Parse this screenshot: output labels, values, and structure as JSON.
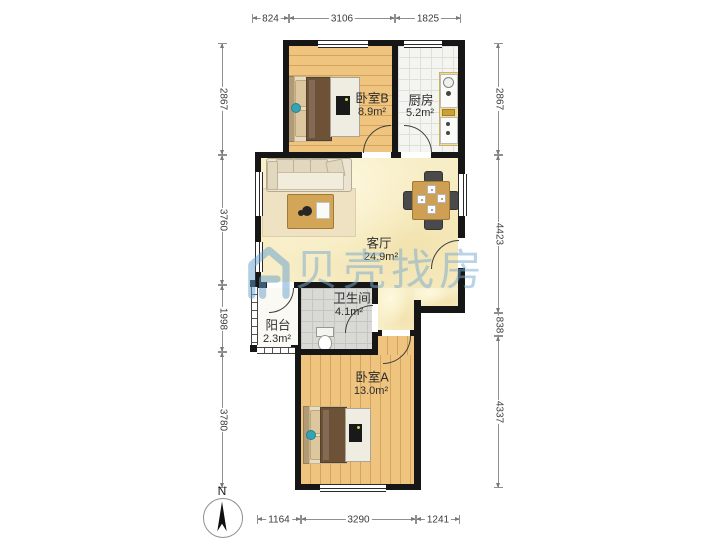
{
  "watermark": {
    "brand": "贝壳找房"
  },
  "compass": {
    "north_label": "N"
  },
  "rooms": {
    "bedroomB": {
      "name": "卧室B",
      "area": "8.9m²"
    },
    "kitchen": {
      "name": "厨房",
      "area": "5.2m²"
    },
    "living": {
      "name": "客厅",
      "area": "24.9m²"
    },
    "bathroom": {
      "name": "卫生间",
      "area": "4.1m²"
    },
    "balcony": {
      "name": "阳台",
      "area": "2.3m²"
    },
    "bedroomA": {
      "name": "卧室A",
      "area": "13.0m²"
    }
  },
  "dims": {
    "top": [
      "824",
      "3106",
      "1825"
    ],
    "bottom": [
      "1164",
      "3290",
      "1241"
    ],
    "left": [
      "2867",
      "3760",
      "1998",
      "3780"
    ],
    "right": [
      "2867",
      "4423",
      "838",
      "4337"
    ]
  },
  "colors": {
    "wall": "#161616",
    "wood_floor": "#eec47f",
    "living_floor": "#f7edc6",
    "watermark_blue": "#7aaacf",
    "accent_teal": "#35a3b5"
  }
}
